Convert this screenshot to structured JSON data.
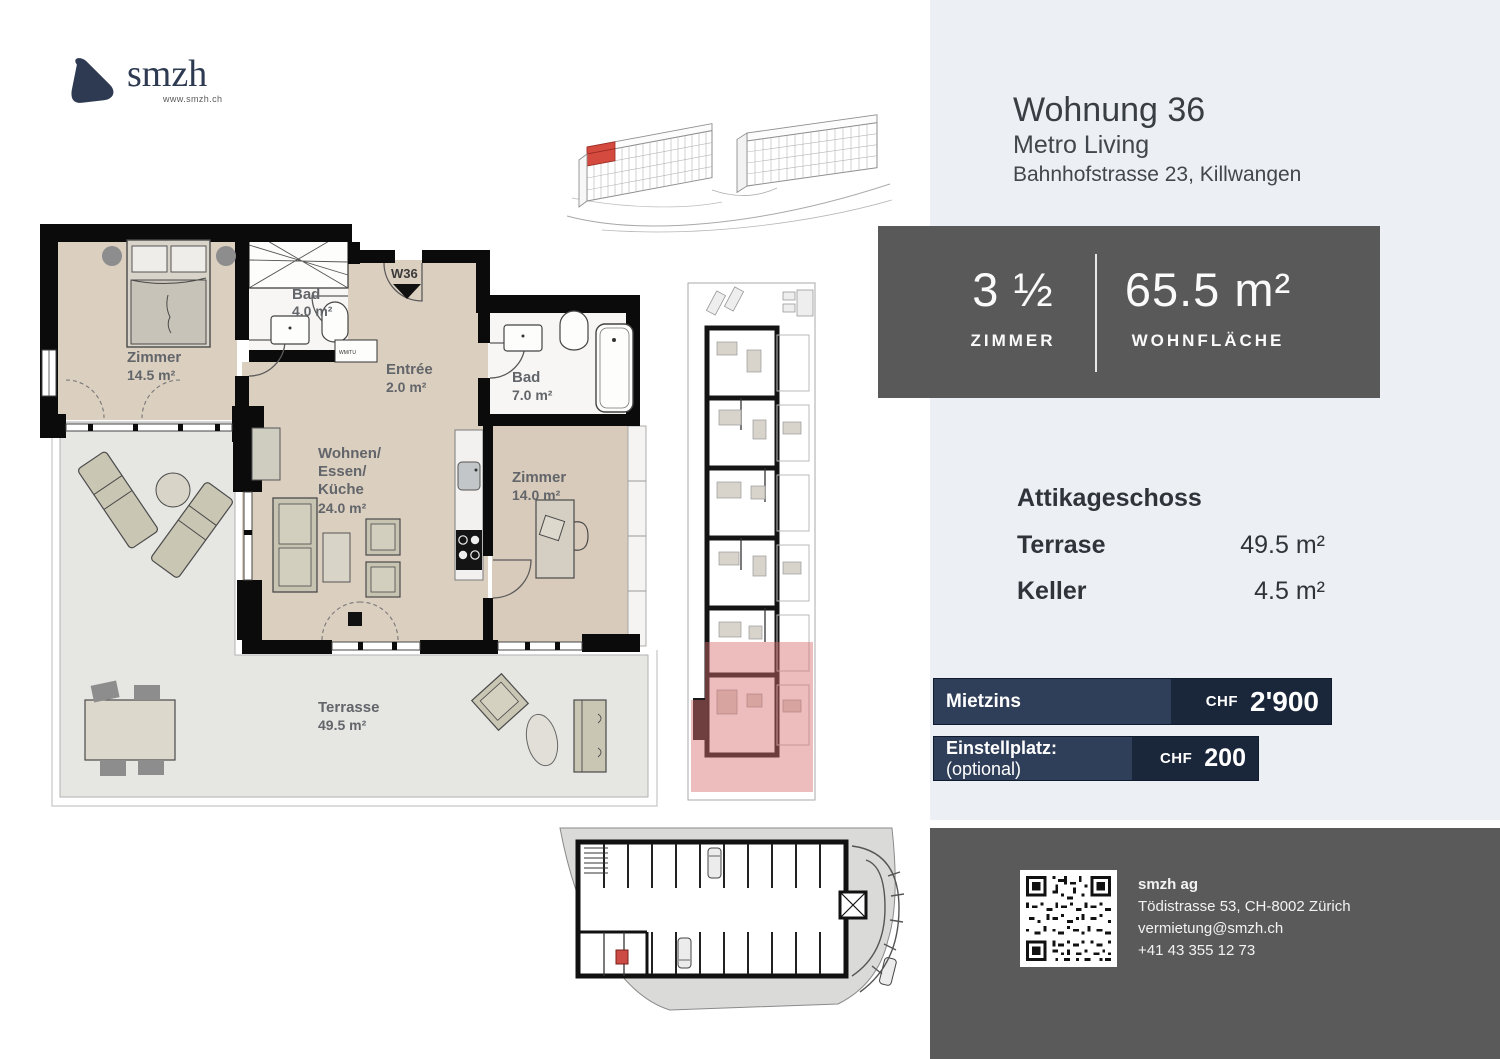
{
  "logo": {
    "brand": "smzh",
    "url": "www.smzh.ch"
  },
  "header": {
    "title": "Wohnung 36",
    "project": "Metro Living",
    "address": "Bahnhofstrasse 23, Killwangen"
  },
  "stats": {
    "rooms_value": "3 ½",
    "rooms_label": "ZIMMER",
    "area_value": "65.5 m²",
    "area_label": "WOHNFLÄCHE"
  },
  "details": {
    "floor_label": "Attikageschoss",
    "rows": [
      {
        "label": "Terrase",
        "value": "49.5 m²"
      },
      {
        "label": "Keller",
        "value": "4.5 m²"
      }
    ]
  },
  "pricing": {
    "rent_label": "Mietzins",
    "rent_currency": "CHF",
    "rent_value": "2'900",
    "parking_label": "Einstellplatz:",
    "parking_optional": "(optional)",
    "parking_currency": "CHF",
    "parking_value": "200"
  },
  "contact": {
    "company": "smzh ag",
    "address": "Tödistrasse 53, CH-8002 Zürich",
    "email": "vermietung@smzh.ch",
    "phone": "+41 43 355 12 73"
  },
  "floorplan": {
    "marker": "W36",
    "utility_label": "WM/TU",
    "rooms": {
      "bedroom1_name": "Zimmer",
      "bedroom1_area": "14.5 m²",
      "bath1_name": "Bad",
      "bath1_area": "4.0 m²",
      "entree_name": "Entrée",
      "entree_area": "2.0 m²",
      "bath2_name": "Bad",
      "bath2_area": "7.0 m²",
      "living_name1": "Wohnen/",
      "living_name2": "Essen/",
      "living_name3": "Küche",
      "living_area": "24.0 m²",
      "bedroom2_name": "Zimmer",
      "bedroom2_area": "14.0 m²",
      "terrace_name": "Terrasse",
      "terrace_area": "49.5 m²"
    }
  },
  "colors": {
    "accent_navy": "#2d3a52",
    "panel_bg": "#ecf0f4",
    "box_gray": "#595959",
    "bar_left": "#2f3e59",
    "bar_right": "#1a2639",
    "unit_highlight": "#d94f4f",
    "floor_beige": "#dbcfc0",
    "terrace_gray": "#e6e6e3"
  }
}
